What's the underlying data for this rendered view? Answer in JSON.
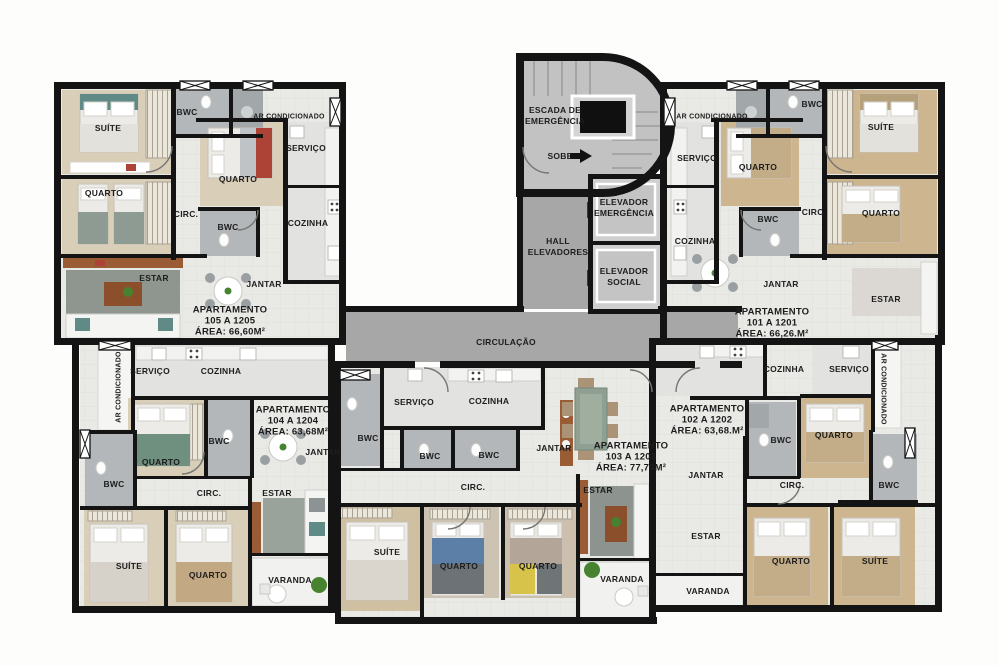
{
  "colors": {
    "wall": "#141414",
    "floor": "#e9e9e6",
    "service_floor": "#e2e2e0",
    "corridor": "#a7a7a7",
    "stair_floor": "#c2c2c2",
    "wood_light": "#d9ceb8",
    "wood_tan": "#cdb58f",
    "bathroom": "#b3b7b9",
    "rug": "#8f958f",
    "balcony": "#f1f1ef",
    "sideboard_brown": "#9a5c35",
    "plant_green": "#46822f",
    "bed_blue": "#5b7fa6",
    "bed_yellow": "#d8c34a",
    "bed_red": "#ad4236",
    "bed_teal": "#5f8a86"
  },
  "core": {
    "labels": [
      {
        "t": "ESCADA DE",
        "x": 555,
        "y": 110
      },
      {
        "t": "EMERGÊNCIA",
        "x": 555,
        "y": 121
      },
      {
        "t": "SOBE",
        "x": 560,
        "y": 156
      },
      {
        "t": "HALL",
        "x": 558,
        "y": 241
      },
      {
        "t": "ELEVADORES",
        "x": 558,
        "y": 252
      },
      {
        "t": "ELEVADOR",
        "x": 624,
        "y": 202
      },
      {
        "t": "EMERGÊNCIA",
        "x": 624,
        "y": 213
      },
      {
        "t": "ELEVADOR",
        "x": 624,
        "y": 271
      },
      {
        "t": "SOCIAL",
        "x": 624,
        "y": 282
      },
      {
        "t": "CIRCULAÇÃO",
        "x": 506,
        "y": 342
      }
    ]
  },
  "apartments": [
    {
      "name": "apartment-105",
      "info": {
        "lines": [
          "APARTAMENTO",
          "105 A 1205",
          "ÁREA: 66,60M²"
        ],
        "x": 230,
        "y": 321
      },
      "rooms": [
        {
          "t": "SUÍTE",
          "x": 108,
          "y": 128
        },
        {
          "t": "BWC",
          "x": 187,
          "y": 112
        },
        {
          "t": "AR CONDICIONADO",
          "x": 289,
          "y": 117,
          "fs": 7
        },
        {
          "t": "SERVIÇO",
          "x": 306,
          "y": 148
        },
        {
          "t": "QUARTO",
          "x": 238,
          "y": 179
        },
        {
          "t": "QUARTO",
          "x": 104,
          "y": 193
        },
        {
          "t": "CIRC.",
          "x": 186,
          "y": 214
        },
        {
          "t": "BWC",
          "x": 228,
          "y": 227
        },
        {
          "t": "COZINHA",
          "x": 308,
          "y": 223
        },
        {
          "t": "ESTAR",
          "x": 154,
          "y": 278
        },
        {
          "t": "JANTAR",
          "x": 264,
          "y": 284
        }
      ]
    },
    {
      "name": "apartment-101",
      "info": {
        "lines": [
          "APARTAMENTO",
          "101 A 1201",
          "ÁREA: 66,26.M²"
        ],
        "x": 772,
        "y": 323
      },
      "rooms": [
        {
          "t": "AR CONDICIONADO",
          "x": 712,
          "y": 117,
          "fs": 7
        },
        {
          "t": "BWC",
          "x": 812,
          "y": 104
        },
        {
          "t": "SUÍTE",
          "x": 881,
          "y": 127
        },
        {
          "t": "SERVIÇO",
          "x": 697,
          "y": 158
        },
        {
          "t": "QUARTO",
          "x": 758,
          "y": 167
        },
        {
          "t": "QUARTO",
          "x": 881,
          "y": 213
        },
        {
          "t": "CIRC.",
          "x": 814,
          "y": 212
        },
        {
          "t": "BWC",
          "x": 768,
          "y": 219
        },
        {
          "t": "COZINHA",
          "x": 695,
          "y": 241
        },
        {
          "t": "JANTAR",
          "x": 781,
          "y": 284
        },
        {
          "t": "ESTAR",
          "x": 886,
          "y": 299
        }
      ]
    },
    {
      "name": "apartment-104",
      "info": {
        "lines": [
          "APARTAMENTO",
          "104 A 1204",
          "ÁREA: 63,68M²"
        ],
        "x": 293,
        "y": 421
      },
      "rooms": [
        {
          "t": "AR CONDICIONADO",
          "x": 119,
          "y": 387,
          "fs": 7,
          "rot": -90
        },
        {
          "t": "SERVIÇO",
          "x": 150,
          "y": 371
        },
        {
          "t": "COZINHA",
          "x": 221,
          "y": 371
        },
        {
          "t": "QUARTO",
          "x": 161,
          "y": 462
        },
        {
          "t": "BWC",
          "x": 219,
          "y": 441
        },
        {
          "t": "BWC",
          "x": 114,
          "y": 484
        },
        {
          "t": "CIRC.",
          "x": 209,
          "y": 493
        },
        {
          "t": "JANTAR",
          "x": 323,
          "y": 452
        },
        {
          "t": "ESTAR",
          "x": 277,
          "y": 493
        },
        {
          "t": "SUÍTE",
          "x": 129,
          "y": 566
        },
        {
          "t": "QUARTO",
          "x": 208,
          "y": 575
        },
        {
          "t": "VARANDA",
          "x": 290,
          "y": 580
        }
      ]
    },
    {
      "name": "apartment-103",
      "info": {
        "lines": [
          "APARTAMENTO",
          "103 A 1203",
          "ÁREA: 77,74M²"
        ],
        "x": 631,
        "y": 457
      },
      "rooms": [
        {
          "t": "SERVIÇO",
          "x": 414,
          "y": 402
        },
        {
          "t": "COZINHA",
          "x": 489,
          "y": 401
        },
        {
          "t": "BWC",
          "x": 368,
          "y": 438
        },
        {
          "t": "BWC",
          "x": 430,
          "y": 456
        },
        {
          "t": "BWC",
          "x": 489,
          "y": 455
        },
        {
          "t": "JANTAR",
          "x": 554,
          "y": 448
        },
        {
          "t": "CIRC.",
          "x": 473,
          "y": 487
        },
        {
          "t": "ESTAR",
          "x": 598,
          "y": 490
        },
        {
          "t": "SUÍTE",
          "x": 387,
          "y": 552
        },
        {
          "t": "QUARTO",
          "x": 459,
          "y": 566
        },
        {
          "t": "QUARTO",
          "x": 538,
          "y": 566
        },
        {
          "t": "VARANDA",
          "x": 622,
          "y": 579
        }
      ]
    },
    {
      "name": "apartment-102",
      "info": {
        "lines": [
          "APARTAMENTO",
          "102 A 1202",
          "ÁREA: 63,68.M²"
        ],
        "x": 707,
        "y": 420
      },
      "rooms": [
        {
          "t": "COZINHA",
          "x": 784,
          "y": 369
        },
        {
          "t": "SERVIÇO",
          "x": 849,
          "y": 369
        },
        {
          "t": "AR CONDICIONADO",
          "x": 883,
          "y": 389,
          "fs": 7,
          "rot": 90
        },
        {
          "t": "BWC",
          "x": 781,
          "y": 440
        },
        {
          "t": "QUARTO",
          "x": 834,
          "y": 435
        },
        {
          "t": "BWC",
          "x": 889,
          "y": 485
        },
        {
          "t": "CIRC.",
          "x": 792,
          "y": 485
        },
        {
          "t": "JANTAR",
          "x": 706,
          "y": 475
        },
        {
          "t": "ESTAR",
          "x": 706,
          "y": 536
        },
        {
          "t": "VARANDA",
          "x": 708,
          "y": 591
        },
        {
          "t": "QUARTO",
          "x": 791,
          "y": 561
        },
        {
          "t": "SUÍTE",
          "x": 875,
          "y": 561
        }
      ]
    }
  ]
}
